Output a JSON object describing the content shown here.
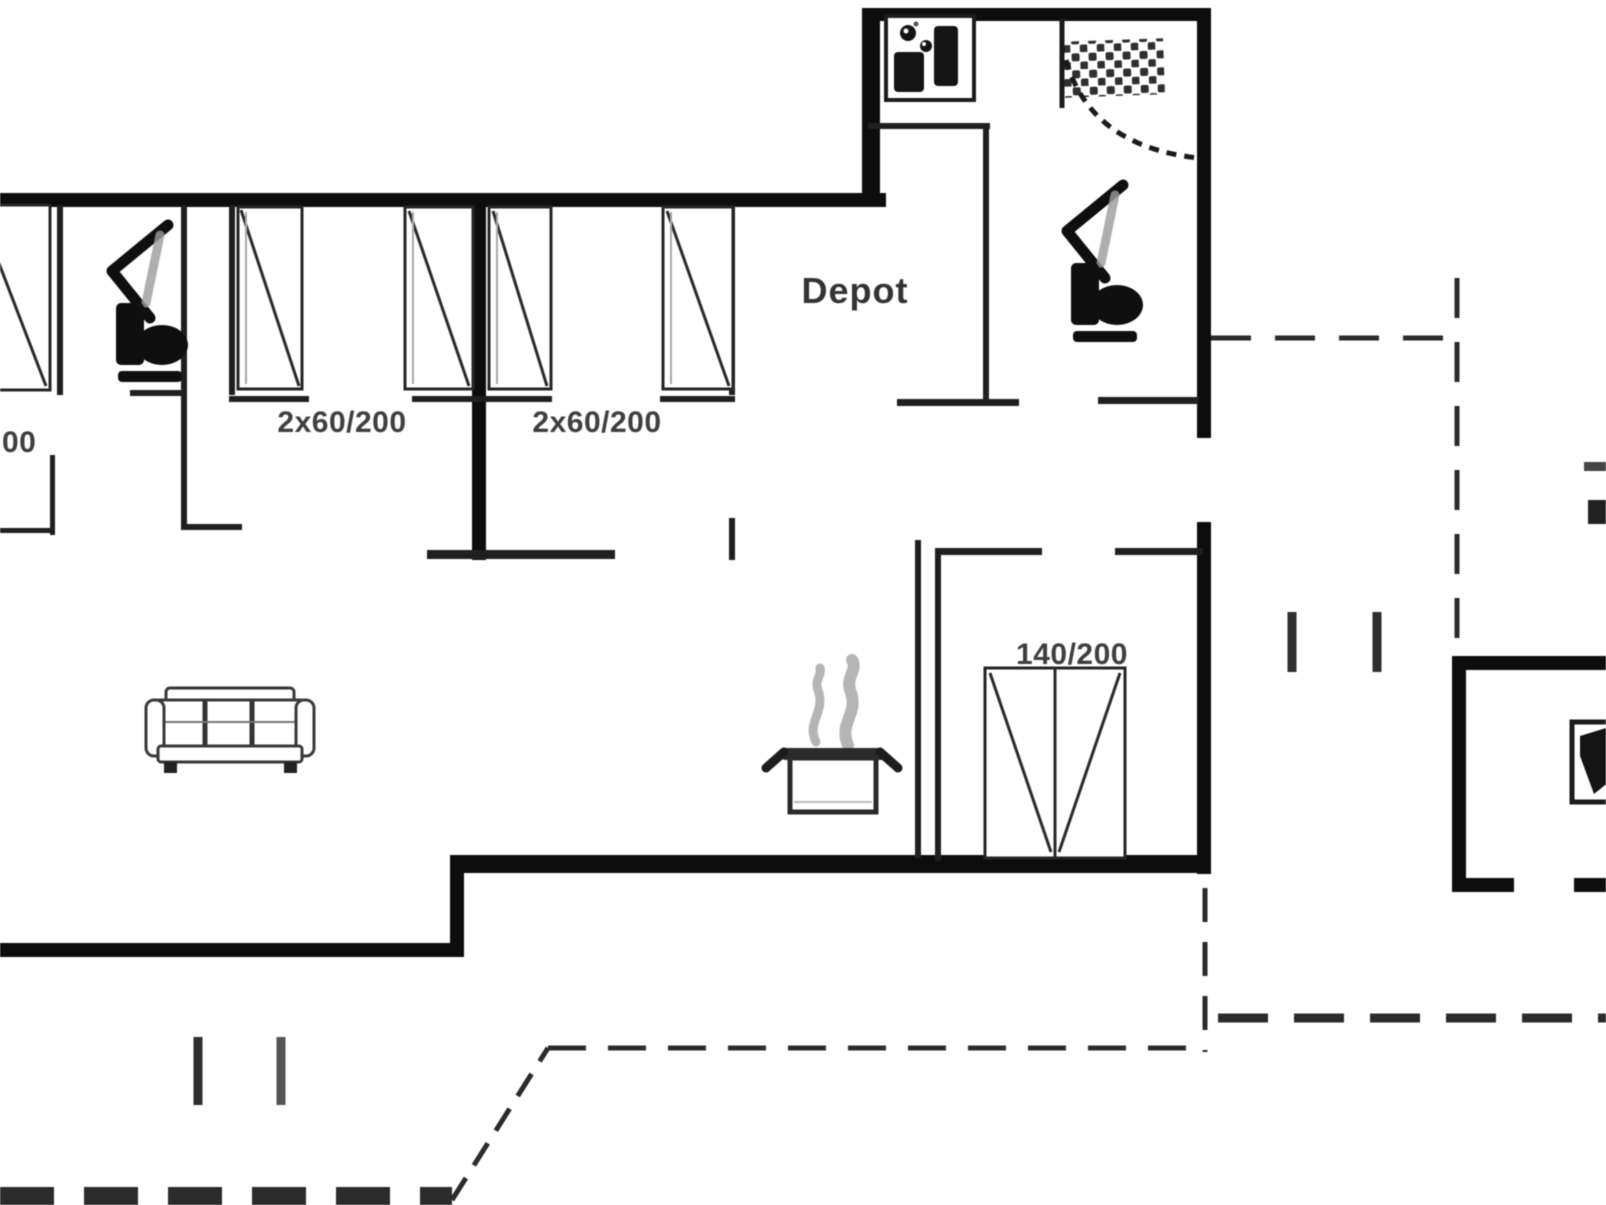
{
  "labels": {
    "depot": "Depot",
    "bedroom_a_beds": "2x60/200",
    "bedroom_b_beds": "2x60/200",
    "double_bed": "140/200",
    "left_edge_partial": "00"
  },
  "colors": {
    "background": "#ffffff",
    "outer_wall": "#0d0d0d",
    "interior_wall": "#1f1f1f",
    "furniture_line": "#3a3a3a",
    "dashed_terrace_line": "#2b2b2b",
    "label_text": "#3f3f3f",
    "steam_gray": "#b5b5b5"
  },
  "icons": [
    "toilet-icon",
    "washbasin-icon",
    "washing-machine-icon",
    "shower-icon",
    "door-swing-icon",
    "single-bed-icon",
    "double-bed-icon",
    "sofa-icon",
    "cooking-pot-icon",
    "steam-icon",
    "stove-icon"
  ]
}
